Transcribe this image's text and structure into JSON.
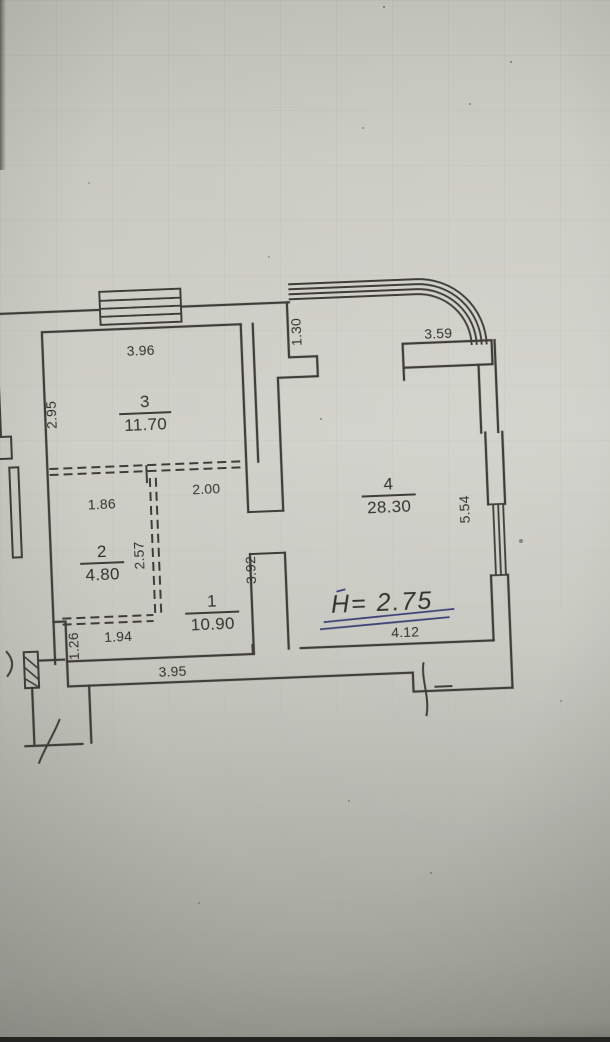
{
  "plan": {
    "type": "apartment floor plan (scanned photo)",
    "rooms": {
      "room1": {
        "number": "1",
        "area": "10.90"
      },
      "room2": {
        "number": "2",
        "area": "4.80"
      },
      "room3": {
        "number": "3",
        "area": "11.70"
      },
      "room4": {
        "number": "4",
        "area": "28.30"
      }
    },
    "dimensions": {
      "room3_top_width": "3.96",
      "room3_left_height": "2.95",
      "partition_upper_left": "1.86",
      "partition_upper_right": "2.00",
      "partition_vertical": "2.57",
      "partition_lower": "1.94",
      "left_wall_lower": "1.26",
      "room1_bottom_width": "3.95",
      "room1_right_height": "3.92",
      "balcony_left": "1.30",
      "room4_top_width": "3.59",
      "room4_right_height": "5.54",
      "room4_bottom_width": "4.12"
    },
    "handwritten": {
      "ceiling_height_note": "H= 2.75"
    },
    "colors": {
      "paper": "#cacbc2",
      "drawing_ink": "#3f3e38",
      "handwriting_ink": "#3d4377"
    }
  }
}
